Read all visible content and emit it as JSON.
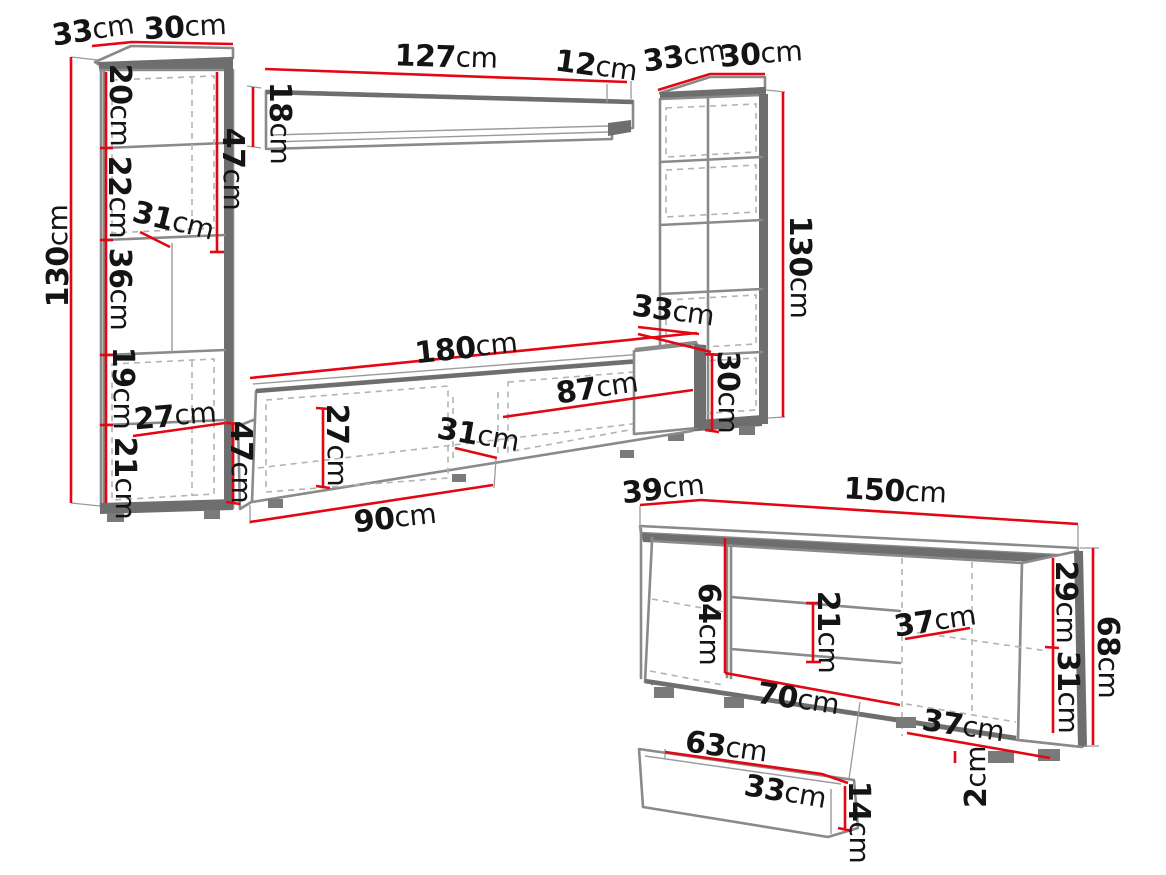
{
  "colors": {
    "dimension_red": "#e30613",
    "outline_gray": "#8a8a8a",
    "panel_dark": "#6e6e6e",
    "dashed_gray": "#b3b3b3",
    "text": "#141414",
    "background": "#ffffff"
  },
  "diagram": {
    "kind": "furniture-dimension-drawing",
    "pieces": [
      "left-cabinet",
      "wall-shelf",
      "right-cabinet",
      "tv-stand",
      "sideboard",
      "drawer"
    ]
  },
  "dims": {
    "lc_depth": {
      "v": "33",
      "u": "cm"
    },
    "lc_width": {
      "v": "30",
      "u": "cm"
    },
    "lc_height": {
      "v": "130",
      "u": "cm"
    },
    "lc_s1": {
      "v": "20",
      "u": "cm"
    },
    "lc_s2": {
      "v": "22",
      "u": "cm"
    },
    "lc_s3": {
      "v": "36",
      "u": "cm"
    },
    "lc_s4": {
      "v": "19",
      "u": "cm"
    },
    "lc_s5": {
      "v": "21",
      "u": "cm"
    },
    "lc_47": {
      "v": "47",
      "u": "cm"
    },
    "lc_31": {
      "v": "31",
      "u": "cm"
    },
    "lc_27": {
      "v": "27",
      "u": "cm"
    },
    "ws_127": {
      "v": "127",
      "u": "cm"
    },
    "ws_12": {
      "v": "12",
      "u": "cm"
    },
    "ws_18": {
      "v": "18",
      "u": "cm"
    },
    "rc_depth": {
      "v": "33",
      "u": "cm"
    },
    "rc_width": {
      "v": "30",
      "u": "cm"
    },
    "rc_height": {
      "v": "130",
      "u": "cm"
    },
    "tv_33": {
      "v": "33",
      "u": "cm"
    },
    "tv_30": {
      "v": "30",
      "u": "cm"
    },
    "tv_180": {
      "v": "180",
      "u": "cm"
    },
    "tv_87": {
      "v": "87",
      "u": "cm"
    },
    "tv_27": {
      "v": "27",
      "u": "cm"
    },
    "tv_31": {
      "v": "31",
      "u": "cm"
    },
    "tv_90": {
      "v": "90",
      "u": "cm"
    },
    "tv_47": {
      "v": "47",
      "u": "cm"
    },
    "sb_39": {
      "v": "39",
      "u": "cm"
    },
    "sb_150": {
      "v": "150",
      "u": "cm"
    },
    "sb_64": {
      "v": "64",
      "u": "cm"
    },
    "sb_21": {
      "v": "21",
      "u": "cm"
    },
    "sb_37a": {
      "v": "37",
      "u": "cm"
    },
    "sb_70": {
      "v": "70",
      "u": "cm"
    },
    "sb_37b": {
      "v": "37",
      "u": "cm"
    },
    "sb_29": {
      "v": "29",
      "u": "cm"
    },
    "sb_31": {
      "v": "31",
      "u": "cm"
    },
    "sb_68": {
      "v": "68",
      "u": "cm"
    },
    "sb_2": {
      "v": "2",
      "u": "cm"
    },
    "dr_63": {
      "v": "63",
      "u": "cm"
    },
    "dr_33": {
      "v": "33",
      "u": "cm"
    },
    "dr_14": {
      "v": "14",
      "u": "cm"
    }
  }
}
